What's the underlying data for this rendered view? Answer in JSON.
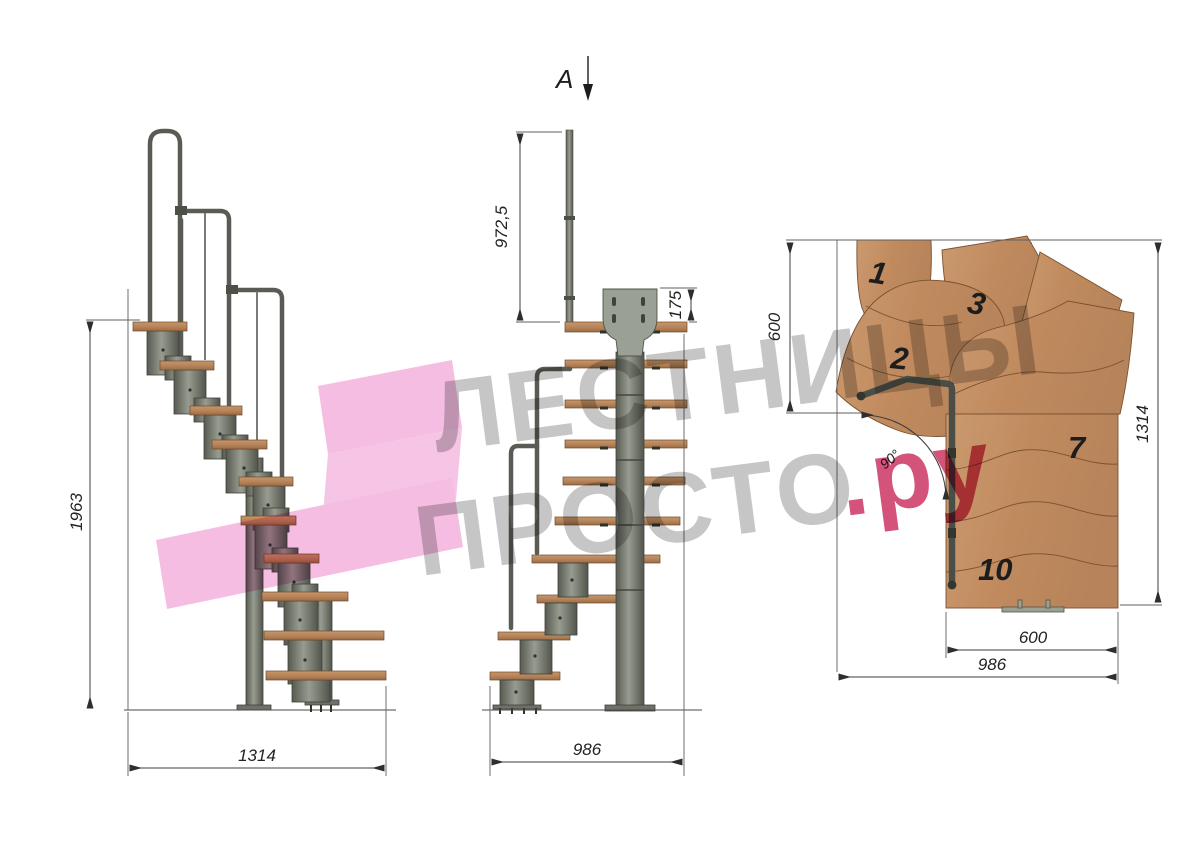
{
  "drawing": {
    "title": "modular-staircase-three-view-drawing",
    "section_marker": "A",
    "side_view": {
      "total_height": "1963",
      "total_length": "1314"
    },
    "front_view": {
      "rail_post_height": "972,5",
      "bracket_height": "175",
      "total_width": "986"
    },
    "plan_view": {
      "landing_depth": "600",
      "total_height": "1314",
      "flight_width": "600",
      "total_width": "986",
      "turn_angle": "90°",
      "step_numbers": [
        "1",
        "2",
        "3",
        "7",
        "10"
      ]
    },
    "watermark": {
      "line1": "ЛЕСТНИЦЫ",
      "line2": "ПРОСТО",
      "suffix": ".ру"
    }
  },
  "colors": {
    "wood": "#bd8a5e",
    "wood_plan": "#c79468",
    "metal": "#767a6f",
    "dimension_line": "#3c3c3c",
    "watermark_gray": "#c6c6c6",
    "watermark_pink": "#d4537b",
    "watermark_pink_shape": "#f5bde2"
  }
}
